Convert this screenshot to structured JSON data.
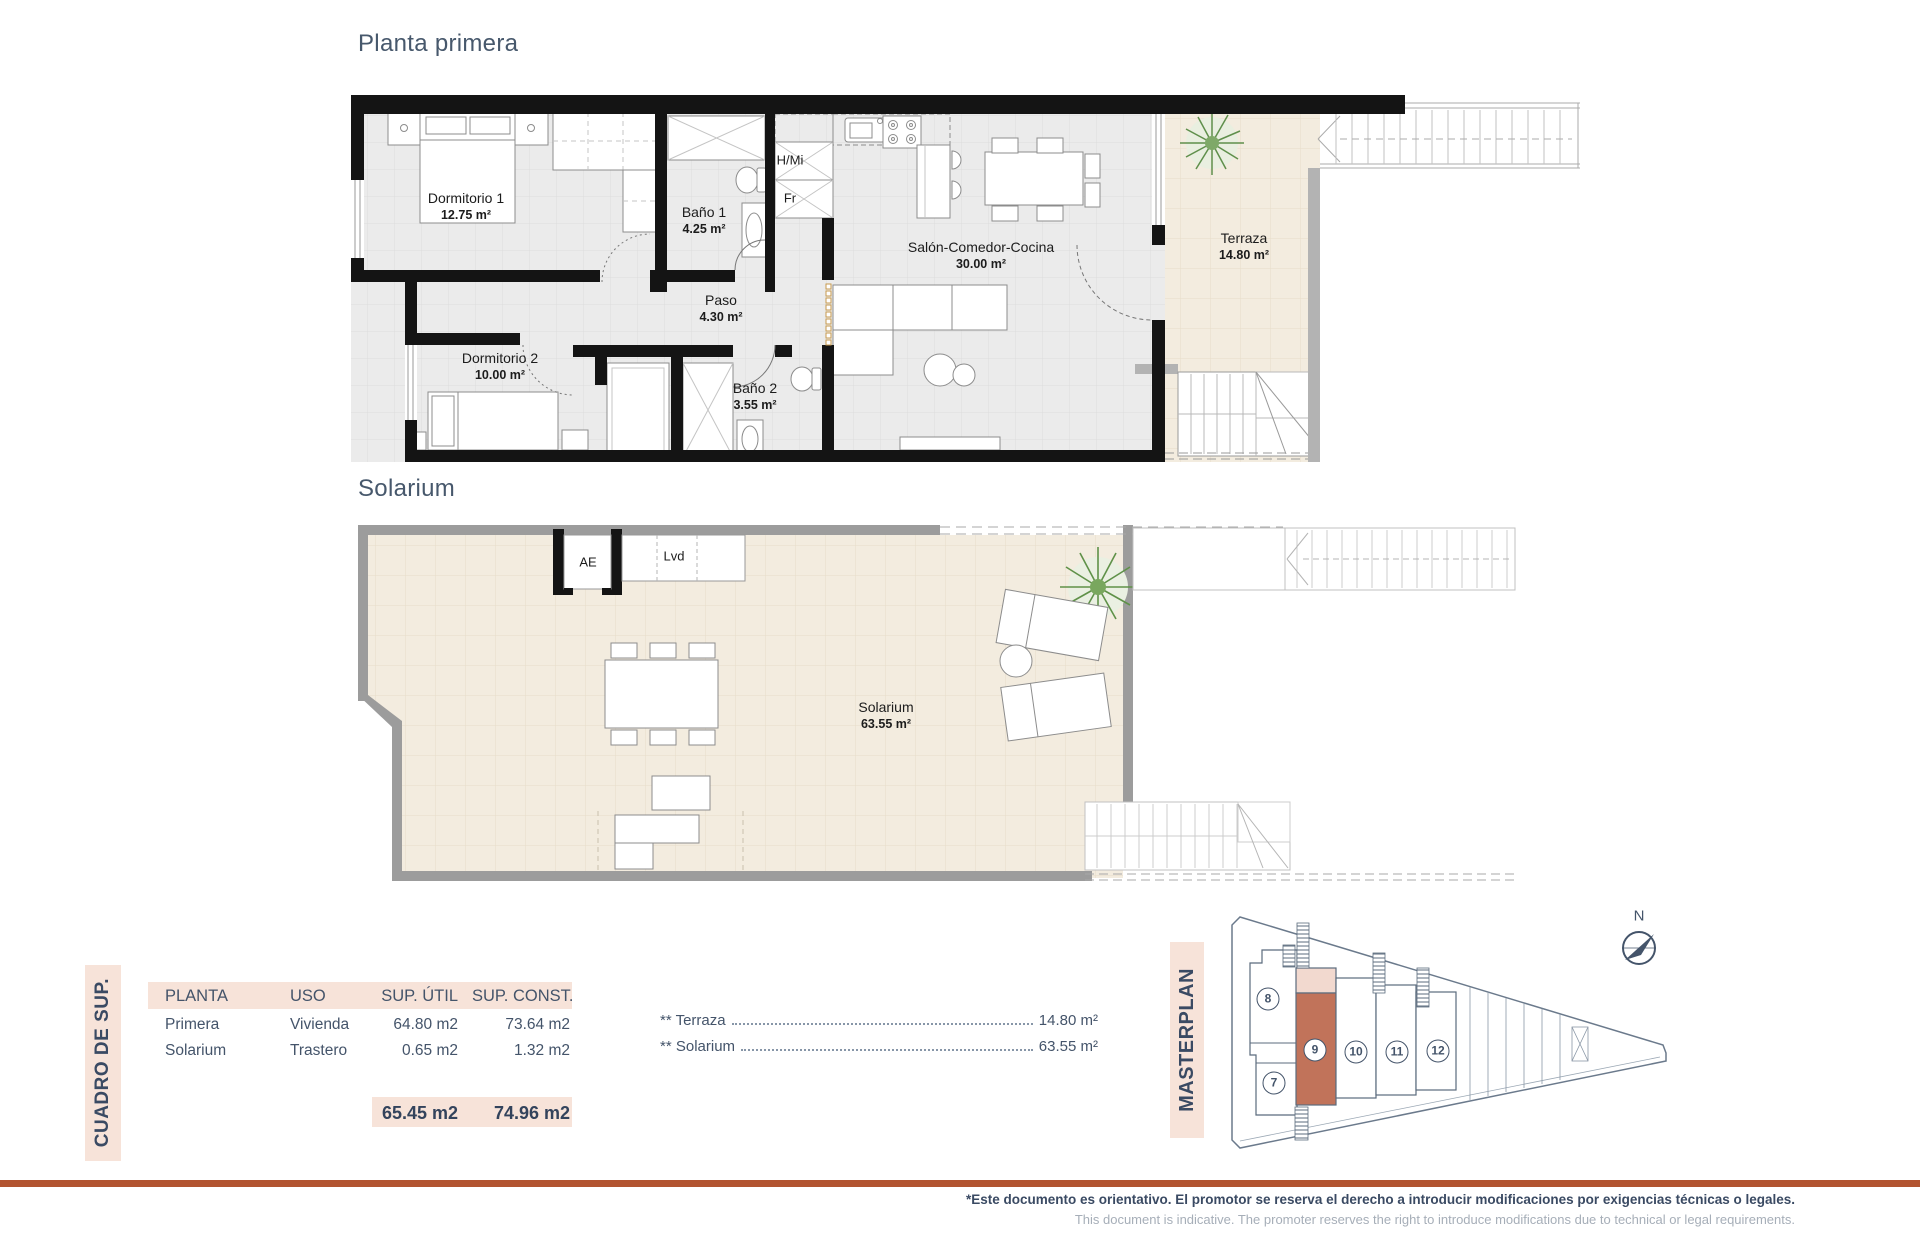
{
  "titles": {
    "floor1": "Planta primera",
    "floor2": "Solarium"
  },
  "floor1": {
    "rooms": {
      "dormitorio1": {
        "name": "Dormitorio 1",
        "area": "12.75 m²"
      },
      "bano1": {
        "name": "Baño 1",
        "area": "4.25 m²"
      },
      "paso": {
        "name": "Paso",
        "area": "4.30 m²"
      },
      "dormitorio2": {
        "name": "Dormitorio 2",
        "area": "10.00 m²"
      },
      "bano2": {
        "name": "Baño 2",
        "area": "3.55 m²"
      },
      "salon": {
        "name": "Salón-Comedor-Cocina",
        "area": "30.00 m²"
      },
      "terraza": {
        "name": "Terraza",
        "area": "14.80 m²"
      }
    },
    "tags": {
      "hmi": "H/Mi",
      "fr": "Fr"
    }
  },
  "floor2": {
    "rooms": {
      "solarium": {
        "name": "Solarium",
        "area": "63.55 m²"
      }
    },
    "tags": {
      "ae": "AE",
      "lvd": "Lvd"
    }
  },
  "summary": {
    "side_label": "CUADRO DE SUP.",
    "headers": [
      "PLANTA",
      "USO",
      "SUP. ÚTIL",
      "SUP. CONST."
    ],
    "rows": [
      [
        "Primera",
        "Vivienda",
        "64.80 m2",
        "73.64 m2"
      ],
      [
        "Solarium",
        "Trastero",
        "0.65 m2",
        "1.32 m2"
      ]
    ],
    "totals": [
      "65.45 m2",
      "74.96 m2"
    ],
    "notes": [
      {
        "label": "** Terraza",
        "value": "14.80 m²"
      },
      {
        "label": "** Solarium",
        "value": "63.55 m²"
      }
    ]
  },
  "masterplan": {
    "label": "MASTERPLAN",
    "north": "N",
    "units": [
      "7",
      "8",
      "9",
      "10",
      "11",
      "12"
    ],
    "highlighted_unit": "9"
  },
  "footer": {
    "line1": "*Este documento es orientativo. El promotor se reserva el derecho a introducir modificaciones por exigencias técnicas o legales.",
    "line2": "This document is indicative. The promoter reserves the right to introduce modifications due to technical or legal requirements."
  },
  "colors": {
    "accent": "#b25430",
    "panel": "#f7e3d9",
    "highlight_unit": "#c1735a",
    "title": "#47586c"
  }
}
